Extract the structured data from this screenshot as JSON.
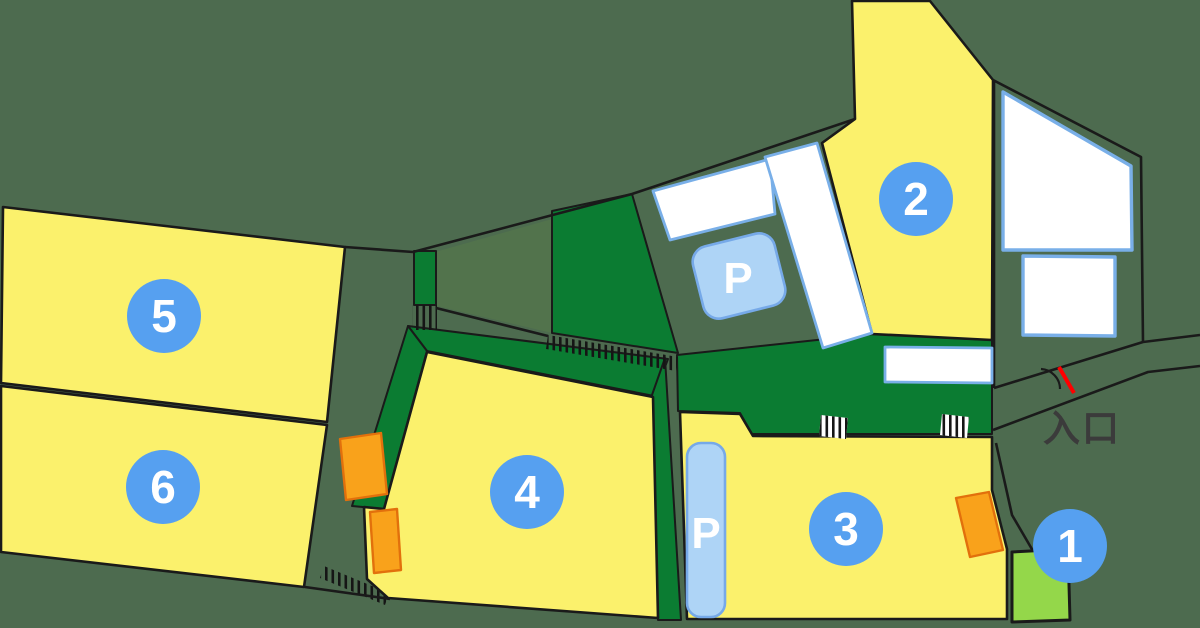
{
  "map": {
    "entrance_label": "入口",
    "areas": [
      {
        "number": "1"
      },
      {
        "number": "2"
      },
      {
        "number": "3"
      },
      {
        "number": "4"
      },
      {
        "number": "5"
      },
      {
        "number": "6"
      }
    ],
    "parking": {
      "upper_label": "P",
      "lower_label": "P"
    },
    "colors": {
      "background": "#4D6B4F",
      "road_tint_green": "#52734C",
      "lot_yellow": "#FBF16C",
      "hedge_green": "#0B7C32",
      "area1_green": "#94D74A",
      "badge_blue": "#56A0F0",
      "badge_text": "#FFFFFF",
      "parking_blue": "#AED4F6",
      "stall_white": "#FFFFFF",
      "orange": "#F9A21B",
      "entrance_red": "#FF0000",
      "label_dark": "#3B3B3B"
    }
  }
}
